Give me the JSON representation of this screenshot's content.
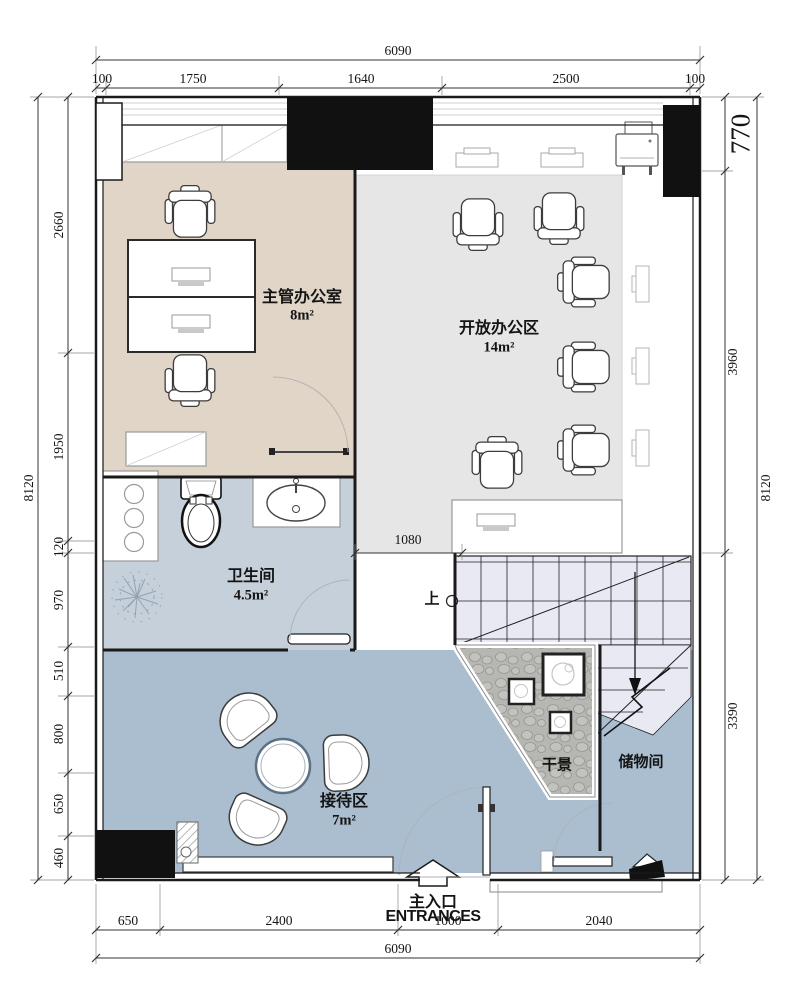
{
  "colors": {
    "executive_office": "#e0d5c7",
    "open_office": "#e6e6e6",
    "bathroom": "#c6d0db",
    "reception": "#aabed0",
    "storage": "#aabed0",
    "stairs": "#e9e9f3",
    "dry_landscape": "#b6b6b3",
    "wall": "#1a1a1a"
  },
  "rooms": {
    "executive": {
      "name": "主管办公室",
      "area": "8m²"
    },
    "open_office": {
      "name": "开放办公区",
      "area": "14m²"
    },
    "bathroom": {
      "name": "卫生间",
      "area": "4.5m²"
    },
    "reception": {
      "name": "接待区",
      "area": "7m²"
    },
    "dry_landscape": {
      "name": "干景"
    },
    "storage": {
      "name": "储物间"
    }
  },
  "dimensions": {
    "top": {
      "overall": "6090",
      "segments": [
        "100",
        "1750",
        "1640",
        "2500",
        "100"
      ]
    },
    "bottom": {
      "overall": "6090",
      "segments": [
        "650",
        "2400",
        "1000",
        "2040"
      ]
    },
    "left": {
      "overall": "8120",
      "segments": [
        "2660",
        "1950",
        "120",
        "970",
        "510",
        "800",
        "650",
        "460"
      ]
    },
    "right": {
      "overall": "8120",
      "segments": [
        "770",
        "3960",
        "3390"
      ]
    },
    "interior": {
      "corridor_width": "1080"
    }
  },
  "annotations": {
    "stair_direction": "上",
    "entrance_label_cn": "主入口",
    "entrance_label_en": "ENTRANCES"
  }
}
